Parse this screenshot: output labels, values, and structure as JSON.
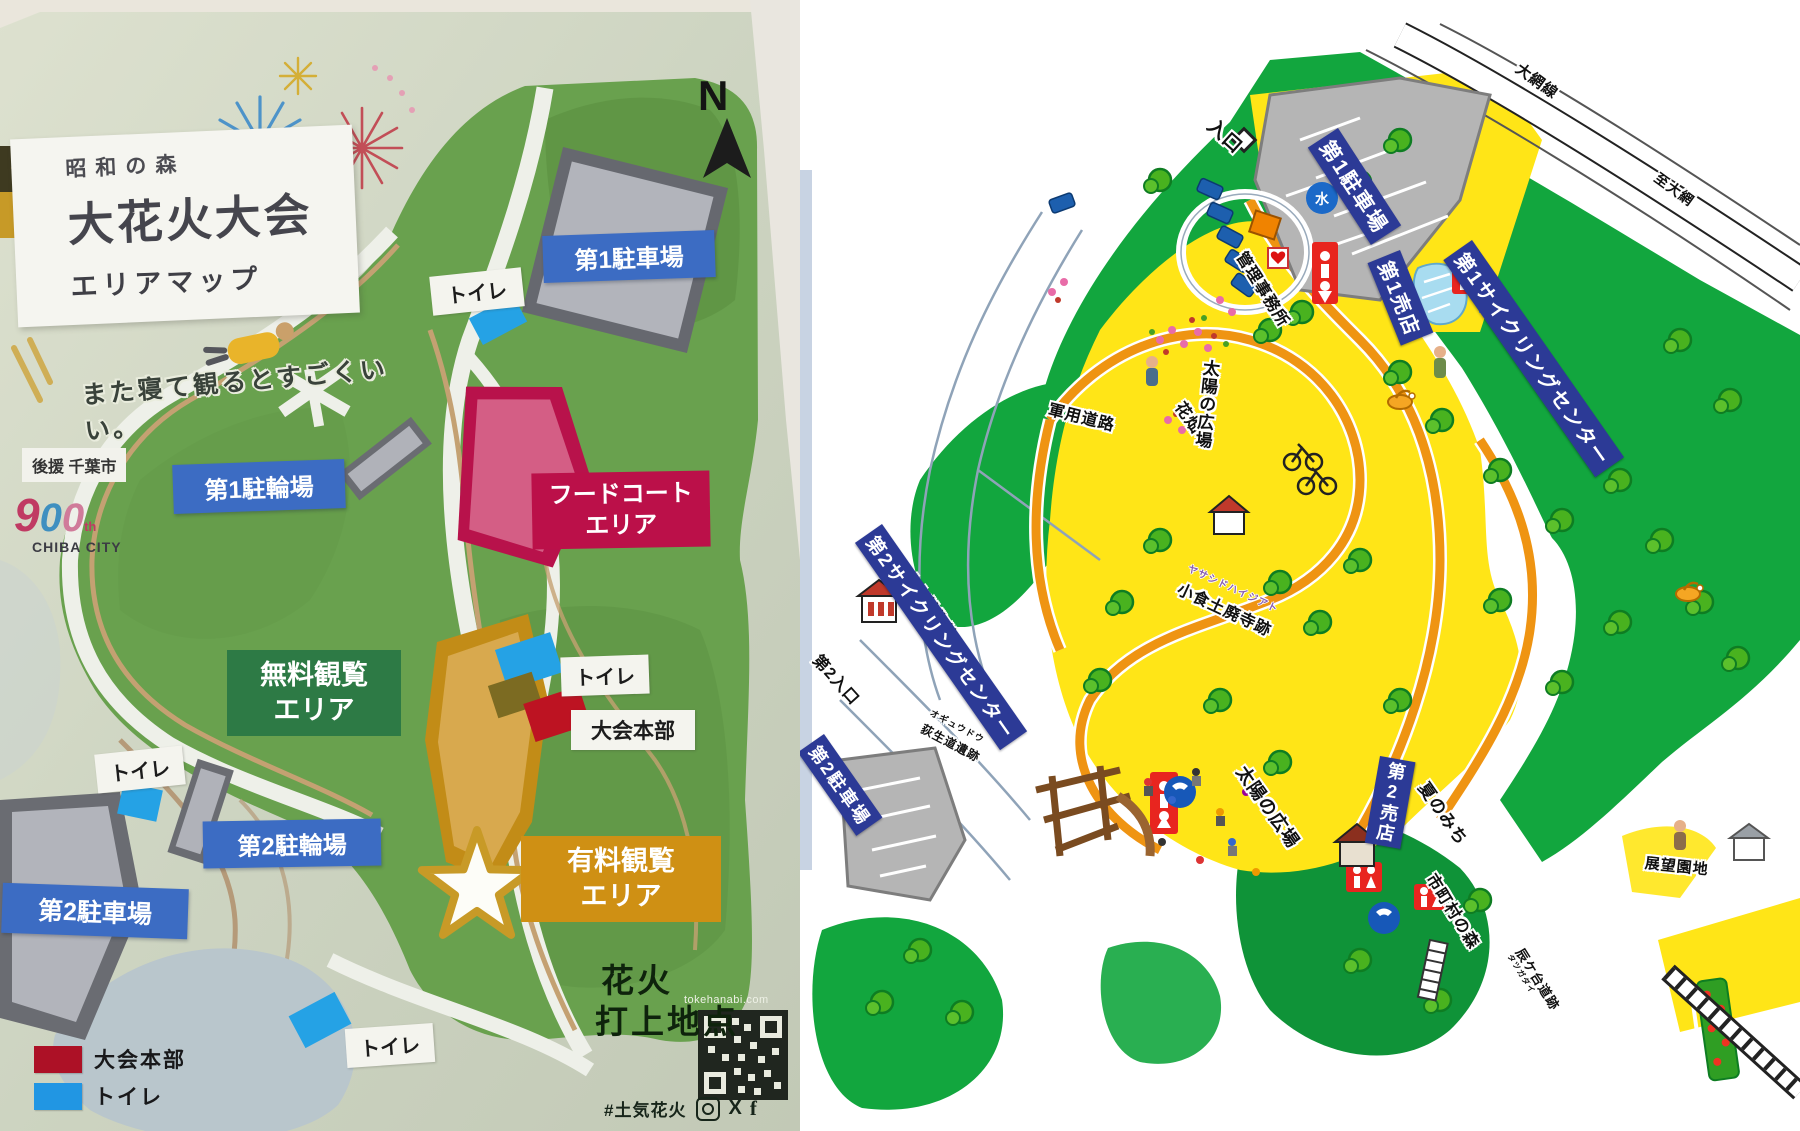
{
  "left_map": {
    "title": {
      "top": "昭和の森",
      "main": "大花火大会",
      "sub": "エリアマップ"
    },
    "tagline": "また寝て観るとすごくいい。",
    "supporter": "後援 千葉市",
    "anniversary": {
      "n1": "9",
      "n2": "0",
      "n3": "0",
      "th": "th",
      "city": "CHIBA CITY"
    },
    "north_letter": "N",
    "banners": {
      "parking1": "第1駐車場",
      "bike1": "第1駐輪場",
      "food1": "フードコート",
      "food2": "エリア",
      "free1": "無料観覧",
      "free2": "エリア",
      "bike2": "第2駐輪場",
      "parking2": "第2駐車場",
      "paid1": "有料観覧",
      "paid2": "エリア"
    },
    "small_labels": {
      "toilet": "トイレ",
      "hq": "大会本部",
      "launch1": "花火",
      "launch2": "打上地点"
    },
    "legend": {
      "hq": "大会本部",
      "toilet": "トイレ",
      "hq_color": "#ad1126",
      "toilet_color": "#2196e3"
    },
    "footer": {
      "url": "tokehanabi.com",
      "hashtag": "#土気花火",
      "x": "X",
      "f": "f"
    }
  },
  "right_map": {
    "labels": {
      "entrance1": "入口",
      "parking1": "第1駐車場",
      "water": "水",
      "admin": "管理事務所",
      "shop1": "第1売店",
      "cycling1": "第1サイクリングセンター",
      "oami_line": "大網線",
      "to_oami": "至大網",
      "flower_field": "花畑",
      "gunyo_road": "軍用道路",
      "plaza_upper": "太陽の広場",
      "plaza_lower": "太陽の広場",
      "haiji_kana": "ヤサシドハイジアト",
      "haiji": "小食土廃寺跡",
      "hoki_museum": "ホキ美術館",
      "cycling2": "第2サイクリングセンター",
      "entrance2": "第2入口",
      "parking2": "第2駐車場",
      "ogyudo_kana": "オギュウドウ",
      "ogyudo": "荻生道遺跡",
      "shop2": "第2売店",
      "summer_path": "夏のみち",
      "municipal_forest": "市町村の森",
      "tatsu_kana": "タツガダイ",
      "tatsu": "辰ケ台道跡",
      "lookout": "展望園地"
    }
  }
}
